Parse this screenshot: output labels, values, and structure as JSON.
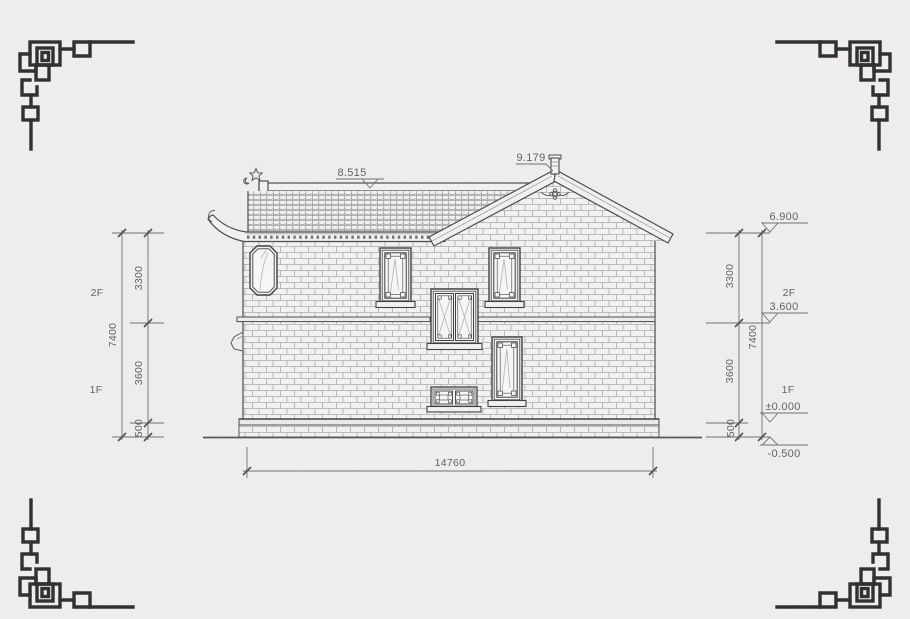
{
  "drawing": {
    "levels": {
      "ridge": "8.515",
      "peak": "9.179",
      "eave": "6.900",
      "floor2": "3.600",
      "floor1": "±0.000",
      "ground": "-0.500"
    },
    "heights": {
      "total": "7400",
      "upper": "3300",
      "lower": "3600",
      "plinth": "500"
    },
    "floors": {
      "second": "2F",
      "first": "1F"
    },
    "width": {
      "total": "14760"
    },
    "colors": {
      "paper": "#f0efed",
      "ink": "#2e2e2e",
      "draw": "#4a4a4a",
      "brick": "#ababab",
      "dim": "#6f6f6f"
    }
  }
}
